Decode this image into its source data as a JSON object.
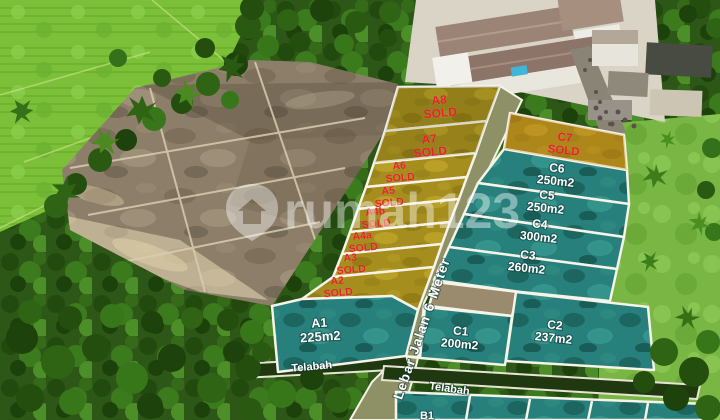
{
  "watermark": {
    "brand": "rumah123",
    "icon": "rumah123-shield-house-icon"
  },
  "road": {
    "label": "Lebar Jalan 6 Meter"
  },
  "channel_labels": [
    "Telabah",
    "Telabah"
  ],
  "colors": {
    "plot_sold_fill": "#a58e1e",
    "plot_available_fill": "#27807c",
    "sold_label_text": "#ea1f2e",
    "available_label_text": "#ffffff",
    "plot_border": "#f6f3e8"
  },
  "plots": {
    "a_series": [
      {
        "id": "A8",
        "sub": "SOLD",
        "status": "sold"
      },
      {
        "id": "A7",
        "sub": "SOLD",
        "status": "sold"
      },
      {
        "id": "A6",
        "sub": "SOLD",
        "status": "sold"
      },
      {
        "id": "A5",
        "sub": "SOLD",
        "status": "sold"
      },
      {
        "id": "A4b",
        "sub": "SOLD",
        "status": "sold"
      },
      {
        "id": "A4a",
        "sub": "SOLD",
        "status": "sold"
      },
      {
        "id": "A3",
        "sub": "SOLD",
        "status": "sold"
      },
      {
        "id": "A2",
        "sub": "SOLD",
        "status": "sold"
      },
      {
        "id": "A1",
        "sub": "225m2",
        "status": "available"
      }
    ],
    "c_series": [
      {
        "id": "C7",
        "sub": "SOLD",
        "status": "sold"
      },
      {
        "id": "C6",
        "sub": "250m2",
        "status": "available"
      },
      {
        "id": "C5",
        "sub": "250m2",
        "status": "available"
      },
      {
        "id": "C4",
        "sub": "300m2",
        "status": "available"
      },
      {
        "id": "C3",
        "sub": "260m2",
        "status": "available"
      },
      {
        "id": "C2",
        "sub": "237m2",
        "status": "available"
      },
      {
        "id": "C1",
        "sub": "200m2",
        "status": "available"
      }
    ],
    "b_series": [
      {
        "id": "B1",
        "status": "available"
      }
    ]
  }
}
